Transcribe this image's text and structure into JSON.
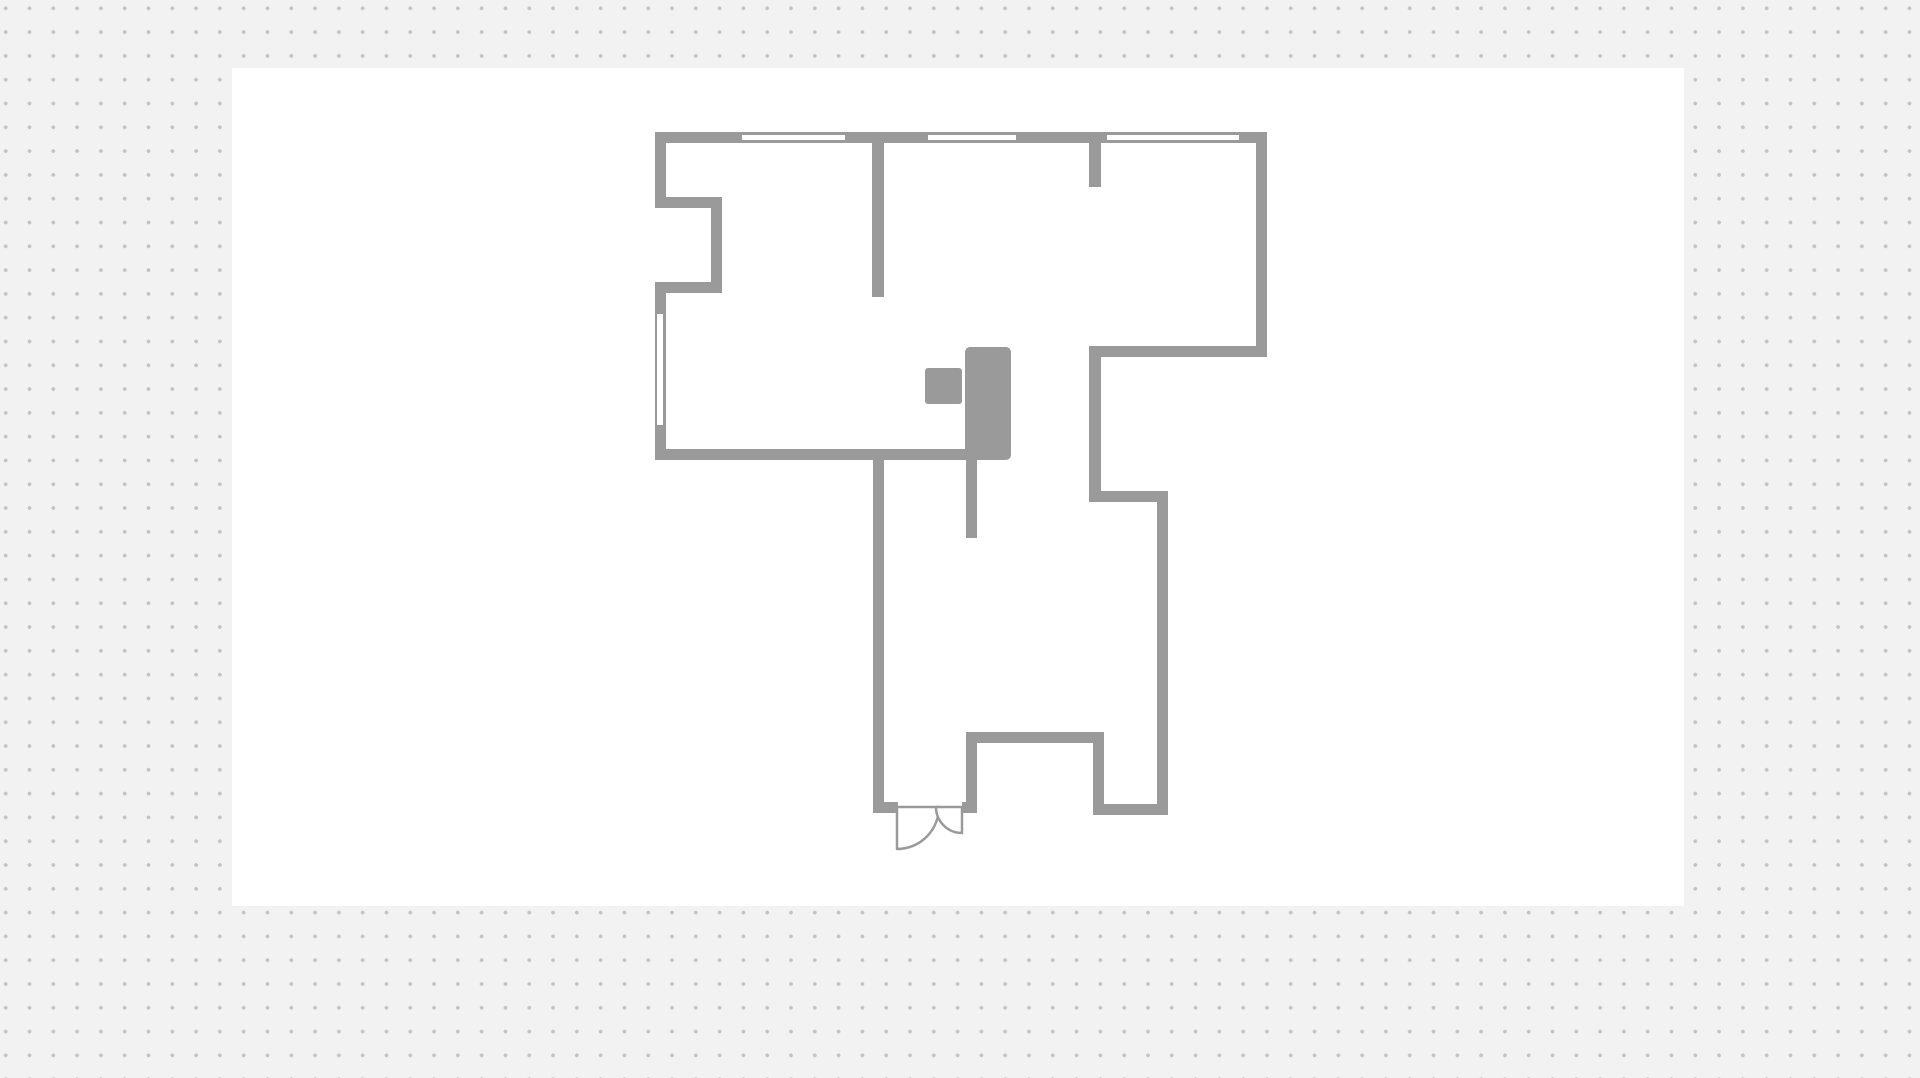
{
  "workspace": {
    "background_color": "#f2f2f2",
    "dot_color": "#c2c2c2",
    "dot_spacing_px": 23.8,
    "dot_radius_px": 1.7,
    "dot_offset_x": -6.2,
    "dot_offset_y": -3.6,
    "canvas": {
      "x": 232,
      "y": 68,
      "width": 1452,
      "height": 838,
      "color": "#ffffff"
    }
  },
  "floorplan": {
    "wall_color": "#9a9a9a",
    "window_glass_color": "#ffffff",
    "furniture_color": "#9a9a9a",
    "door_leaf_fill": "#ffffff",
    "door_leaf_stroke": "#9a9a9a",
    "door_leaf_stroke_width": 2.5,
    "walls": [
      {
        "name": "top-exterior",
        "x": 655,
        "y": 132,
        "w": 612,
        "h": 11
      },
      {
        "name": "left-exterior-upper",
        "x": 655,
        "y": 132,
        "w": 11,
        "h": 76
      },
      {
        "name": "left-niche-top",
        "x": 655,
        "y": 197,
        "w": 67,
        "h": 11
      },
      {
        "name": "left-niche-right",
        "x": 711,
        "y": 197,
        "w": 11,
        "h": 96
      },
      {
        "name": "left-niche-bottom",
        "x": 655,
        "y": 282,
        "w": 67,
        "h": 11
      },
      {
        "name": "left-exterior-lower",
        "x": 655,
        "y": 282,
        "w": 11,
        "h": 178
      },
      {
        "name": "upper-room-bottom",
        "x": 655,
        "y": 449,
        "w": 317,
        "h": 11
      },
      {
        "name": "partition-top-center",
        "x": 872,
        "y": 143,
        "w": 12,
        "h": 154
      },
      {
        "name": "partition-top-stub",
        "x": 1089,
        "y": 143,
        "w": 12,
        "h": 44
      },
      {
        "name": "right-exterior",
        "x": 1256,
        "y": 132,
        "w": 11,
        "h": 225
      },
      {
        "name": "upper-right-room-bottom",
        "x": 1089,
        "y": 346,
        "w": 178,
        "h": 11
      },
      {
        "name": "mid-right-vertical",
        "x": 1089,
        "y": 346,
        "w": 12,
        "h": 156
      },
      {
        "name": "mid-right-step",
        "x": 1089,
        "y": 491,
        "w": 79,
        "h": 11
      },
      {
        "name": "lower-right-exterior",
        "x": 1157,
        "y": 491,
        "w": 11,
        "h": 324
      },
      {
        "name": "bottom-right-exterior",
        "x": 1093,
        "y": 804,
        "w": 75,
        "h": 11
      },
      {
        "name": "entry-notch-right",
        "x": 1093,
        "y": 742,
        "w": 11,
        "h": 73
      },
      {
        "name": "entry-notch-top",
        "x": 966,
        "y": 732,
        "w": 138,
        "h": 11
      },
      {
        "name": "entry-notch-left",
        "x": 966,
        "y": 732,
        "w": 11,
        "h": 75
      },
      {
        "name": "door-right-jamb",
        "x": 962,
        "y": 802,
        "w": 15,
        "h": 11
      },
      {
        "name": "door-left-segment",
        "x": 873,
        "y": 802,
        "w": 25,
        "h": 11
      },
      {
        "name": "lower-left-exterior",
        "x": 873,
        "y": 449,
        "w": 11,
        "h": 364
      },
      {
        "name": "partition-center-stub",
        "x": 966,
        "y": 459,
        "w": 11,
        "h": 79
      }
    ],
    "windows": [
      {
        "name": "top-window-1",
        "x": 742,
        "y": 135,
        "w": 103,
        "h": 5
      },
      {
        "name": "top-window-2",
        "x": 928,
        "y": 135,
        "w": 88,
        "h": 5
      },
      {
        "name": "top-window-3",
        "x": 1107,
        "y": 135,
        "w": 132,
        "h": 5
      },
      {
        "name": "left-window",
        "x": 657,
        "y": 314,
        "w": 6,
        "h": 111
      }
    ],
    "furniture": [
      {
        "name": "cabinet-large",
        "x": 965,
        "y": 347,
        "w": 46,
        "h": 113,
        "rx": 5
      },
      {
        "name": "cabinet-small",
        "x": 925,
        "y": 368,
        "w": 37,
        "h": 36,
        "rx": 3
      }
    ],
    "door": {
      "name": "entry-double-door",
      "leaves": [
        {
          "name": "door-leaf-left",
          "path": "M 897 807 L 897 849 A 42 42 0 0 0 939 807 Z"
        },
        {
          "name": "door-leaf-right",
          "path": "M 962 807 L 936 807 A 26 26 0 0 0 962 833 Z"
        }
      ]
    }
  }
}
